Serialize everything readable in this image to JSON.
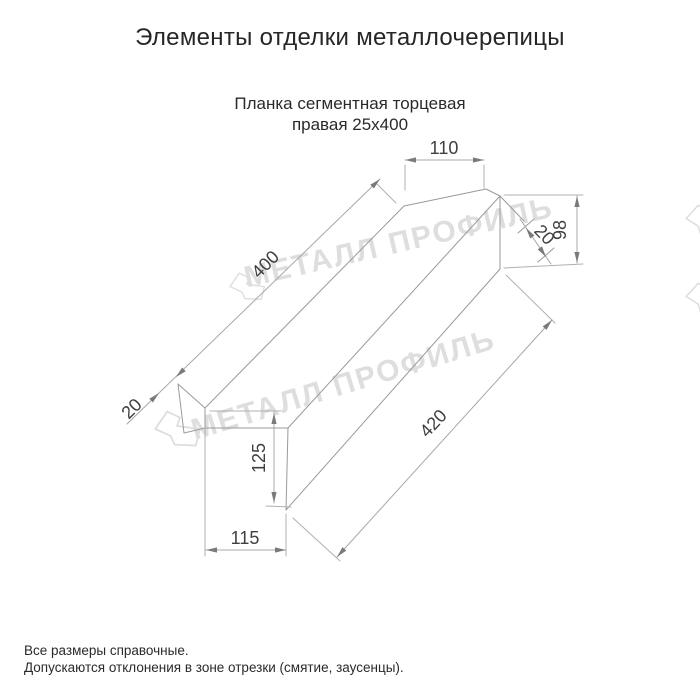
{
  "header": {
    "title": "Элементы отделки металлочерепицы",
    "subtitle_line1": "Планка сегментная торцевая",
    "subtitle_line2": "правая 25х400"
  },
  "drawing": {
    "watermark_text": "МЕТАЛЛ ПРОФИЛЬ",
    "dimensions": {
      "cap_top_width": "110",
      "cap_height": "98",
      "cap_fold_width": "20",
      "top_edge_length": "400",
      "bottom_edge_length": "420",
      "start_fold_width": "20",
      "face_height": "125",
      "bottom_width": "115"
    }
  },
  "footer": {
    "note_line1": "Все размеры справочные.",
    "note_line2": "Допускаются отклонения в зоне отрезки (смятие, заусенцы)."
  },
  "colors": {
    "background": "#ffffff",
    "line": "#9a9a9a",
    "dim_text": "#3f3f3f",
    "title_text": "#262626",
    "watermark": "#dedede"
  }
}
